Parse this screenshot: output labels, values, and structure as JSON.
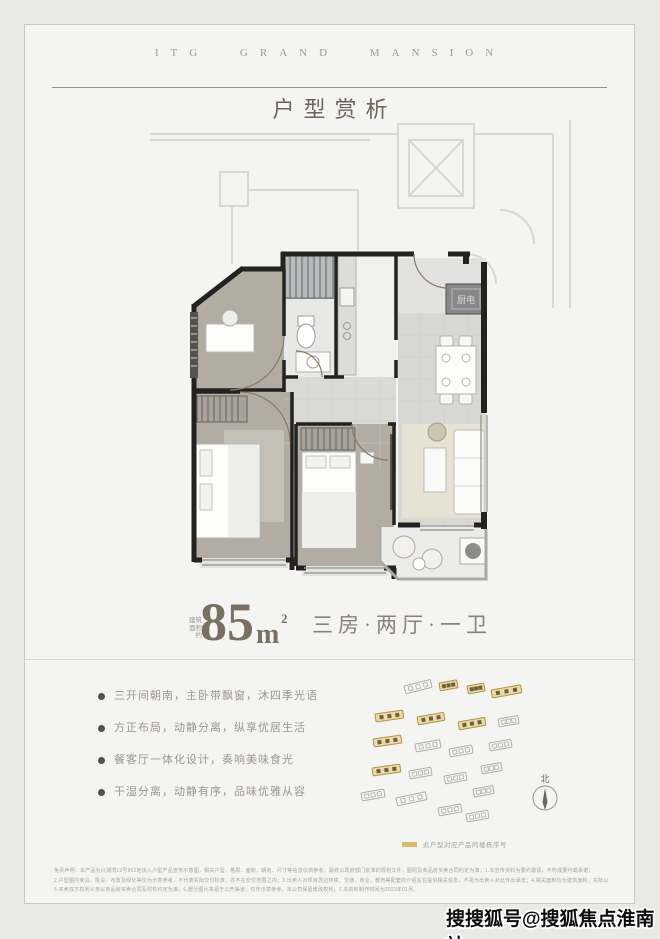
{
  "brand": "ITG GRAND MANSION",
  "title": "户型赏析",
  "area": {
    "note_line1": "建筑",
    "note_line2": "面积约",
    "value": "85",
    "unit": "m",
    "sup": "2",
    "layout": "三房·两厅·一卫"
  },
  "features": [
    "三开间朝南，主卧带飘窗，沐四季光语",
    "方正布局，动静分离，纵享优居生活",
    "餐客厅一体化设计，奏响美味食光",
    "干湿分离，动静有序，品味优雅从容"
  ],
  "floorplan": {
    "cabinet_label": "厨电"
  },
  "siteplan": {
    "compass_label": "北",
    "legend_label": "此户型对应产品的楼栋序号",
    "highlight_color": "#d9ba67",
    "buildings": [
      {
        "x": 52,
        "y": 16,
        "w": 27,
        "hl": false,
        "r": -14
      },
      {
        "x": 87,
        "y": 13,
        "w": 18,
        "hl": true,
        "r": -10
      },
      {
        "x": 115,
        "y": 16,
        "w": 17,
        "hl": true,
        "r": -10
      },
      {
        "x": 139,
        "y": 20,
        "w": 30,
        "hl": true,
        "r": -10
      },
      {
        "x": 23,
        "y": 44,
        "w": 28,
        "hl": true,
        "r": -8
      },
      {
        "x": 65,
        "y": 47,
        "w": 27,
        "hl": true,
        "r": -10
      },
      {
        "x": 106,
        "y": 52,
        "w": 27,
        "hl": true,
        "r": -10
      },
      {
        "x": 146,
        "y": 49,
        "w": 20,
        "hl": false,
        "r": -10
      },
      {
        "x": 21,
        "y": 69,
        "w": 28,
        "hl": true,
        "r": -8
      },
      {
        "x": 63,
        "y": 74,
        "w": 25,
        "hl": false,
        "r": -10
      },
      {
        "x": 97,
        "y": 79,
        "w": 23,
        "hl": false,
        "r": -10
      },
      {
        "x": 137,
        "y": 73,
        "w": 22,
        "hl": false,
        "r": -10
      },
      {
        "x": 20,
        "y": 98,
        "w": 28,
        "hl": true,
        "r": -8
      },
      {
        "x": 57,
        "y": 101,
        "w": 22,
        "hl": false,
        "r": -10
      },
      {
        "x": 92,
        "y": 106,
        "w": 22,
        "hl": false,
        "r": -10
      },
      {
        "x": 129,
        "y": 96,
        "w": 20,
        "hl": false,
        "r": -10
      },
      {
        "x": 9,
        "y": 123,
        "w": 23,
        "hl": false,
        "r": -10
      },
      {
        "x": 44,
        "y": 128,
        "w": 30,
        "hl": false,
        "r": -12
      },
      {
        "x": 86,
        "y": 138,
        "w": 23,
        "hl": false,
        "r": -10
      },
      {
        "x": 114,
        "y": 144,
        "w": 22,
        "hl": false,
        "r": -10
      },
      {
        "x": 121,
        "y": 119,
        "w": 20,
        "hl": false,
        "r": -10
      }
    ]
  },
  "fineprint": {
    "lines": [
      "免责声明：本产品为兴湖湾12号902地块入户型产品宣传示意图，相关户型、格局、面积、朝向、尺寸等信息仅供参考，最终以政府部门批准的规划文件、图则及商品房买卖合同约定为准；1.本宣传资料为要约邀请，不构成要约或承诺；",
      "2.户型图内家具、陈设、布置及绿化等仅为示意参考，不代表实际交付标准，亦不在交付范围之内；3.出卖人对项目周边环境、交通、商业、教育等配套的介绍旨在提供相关信息，不视为出卖人对此作出承诺；4.相关面积均为建筑面积，实际以实测面积及合同约定为准；",
      "5.买卖双方权利义务以商品房买卖合同及附件约定为准；6.部分图片来源于公开渠道，仅作示意参考，本公司保留修改权利；7.本资料制作时间为2023年01月。"
    ]
  },
  "watermark": "搜搜狐号@搜狐焦点淮南站",
  "colors": {
    "accent": "#d9ba67",
    "wall": "#23221e",
    "room": "#b3aca3",
    "title": "#6e6459"
  }
}
